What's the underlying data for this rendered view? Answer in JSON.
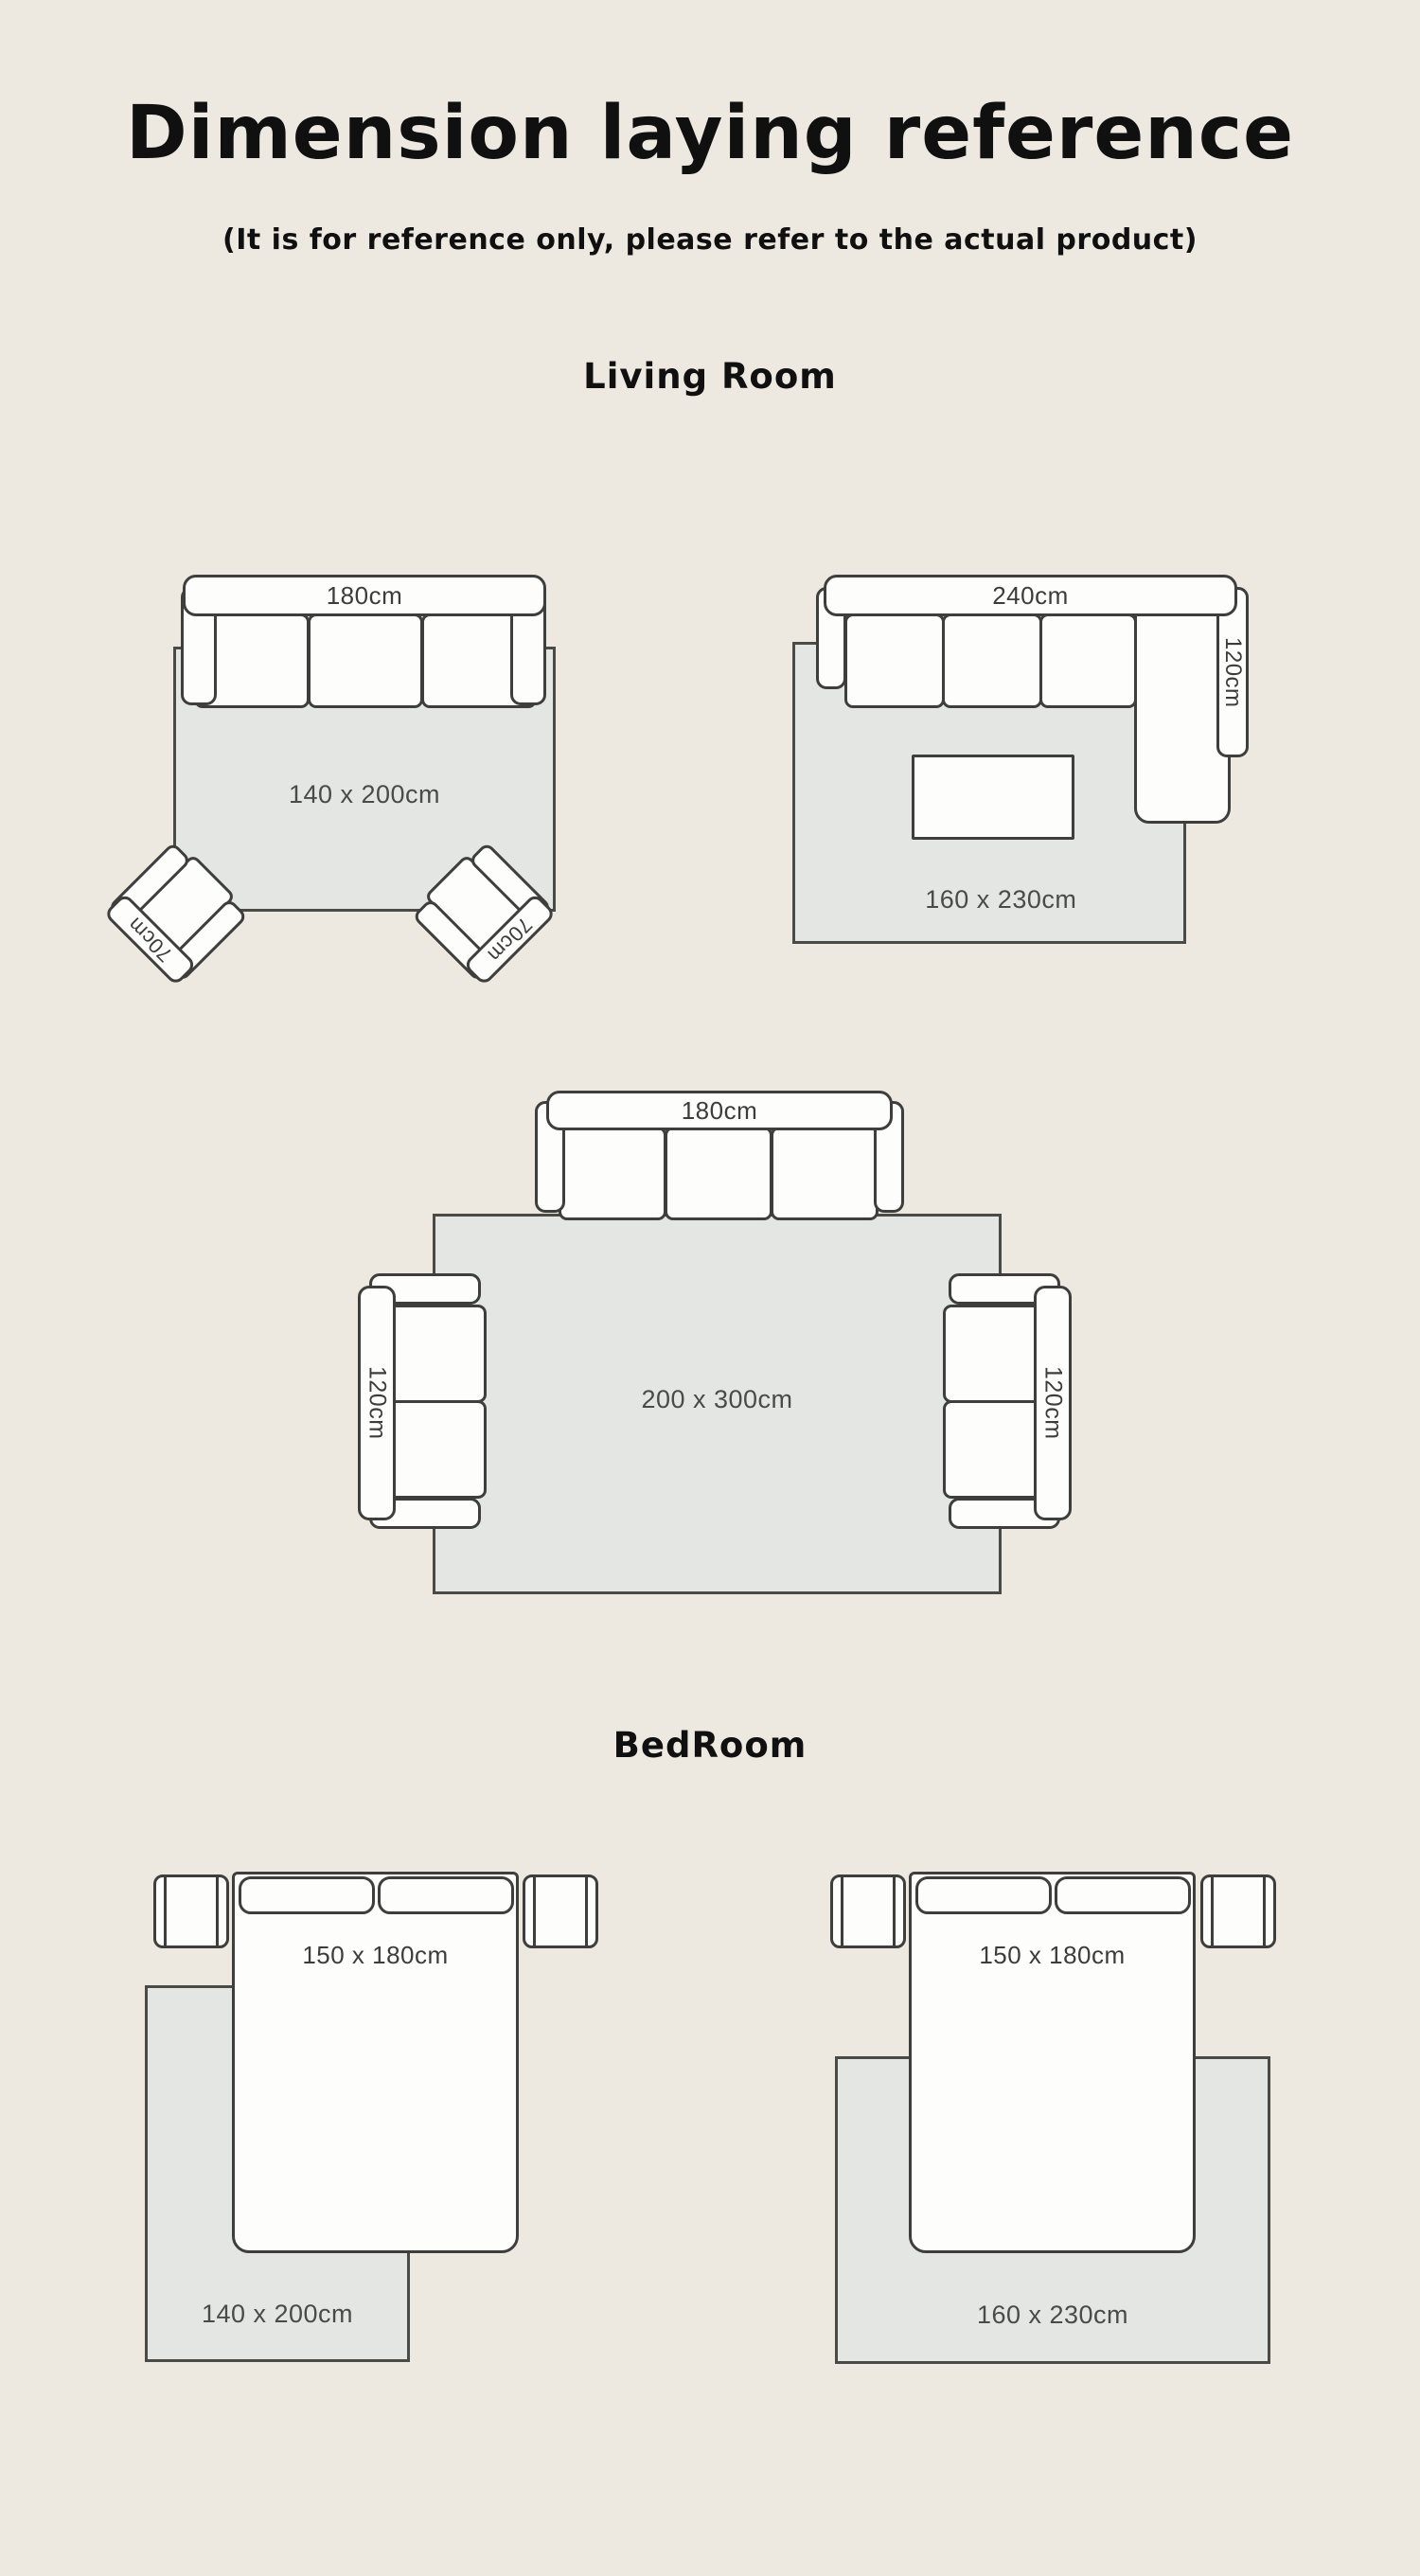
{
  "header": {
    "title": "Dimension laying reference",
    "subtitle": "(It is for reference only, please refer to the actual product)"
  },
  "sections": {
    "living_room": "Living Room",
    "bedroom": "BedRoom"
  },
  "colors": {
    "background": "#EDE8E0",
    "rug_fill": "#E3E6E2",
    "outline": "#3E3E3C",
    "furniture_fill": "#FDFDFB",
    "label_text": "#4A4A48"
  },
  "living_room": {
    "layout1": {
      "sofa_width": "180cm",
      "armchair_left": "70cm",
      "armchair_right": "70cm",
      "rug_size": "140 x 200cm"
    },
    "layout2": {
      "sofa_width": "240cm",
      "chaise_depth": "120cm",
      "rug_size": "160 x 230cm"
    },
    "layout3": {
      "sofa_width": "180cm",
      "side_sofa_left": "120cm",
      "side_sofa_right": "120cm",
      "rug_size": "200 x 300cm"
    }
  },
  "bedroom": {
    "layout1": {
      "bed_size": "150 x 180cm",
      "rug_size": "140 x 200cm"
    },
    "layout2": {
      "bed_size": "150 x 180cm",
      "rug_size": "160 x 230cm"
    }
  }
}
